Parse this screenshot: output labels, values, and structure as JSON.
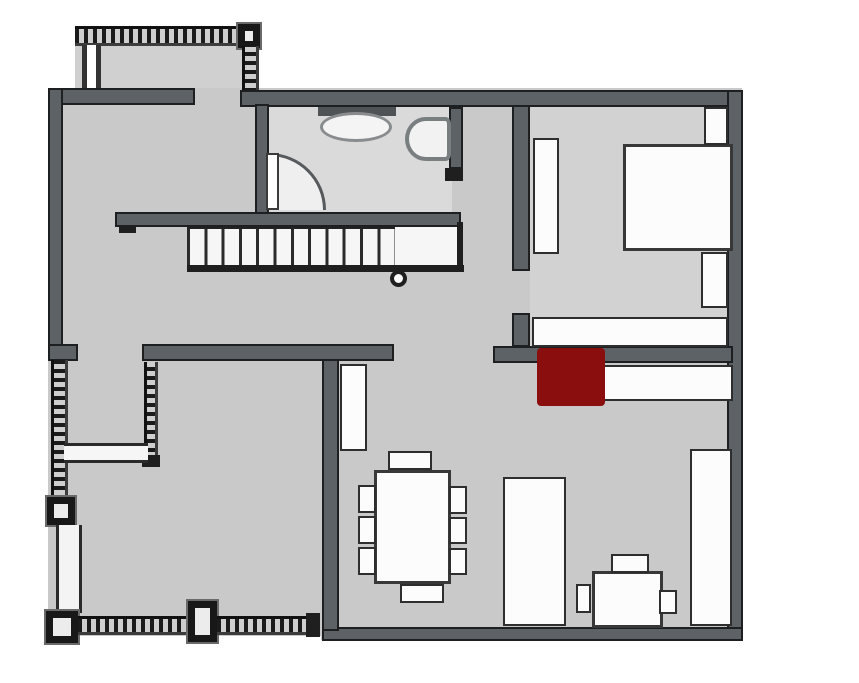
{
  "canvas": {
    "width": 859,
    "height": 683,
    "background": "#ffffff"
  },
  "palette": {
    "floor_gray": "#c9c9c9",
    "floor_light_gray": "#d6d6d6",
    "wall_gray": "#5d6266",
    "wall_edge_black": "#1e1f20",
    "furniture_white": "#fcfcfc",
    "highlight_red": "#8b0e0e"
  },
  "elements": [
    {
      "name": "balcony-floor",
      "type": "floor",
      "rect": [
        75,
        30,
        183,
        62
      ],
      "color": "#d0d0d0",
      "interactable": false
    },
    {
      "name": "main-floor",
      "type": "floor",
      "rect": [
        48,
        88,
        694,
        552
      ],
      "interactable": false
    },
    {
      "name": "bathroom-floor",
      "type": "floor",
      "rect": [
        262,
        104,
        190,
        110
      ],
      "color": "#dadada",
      "interactable": false
    },
    {
      "name": "bedroom-floor",
      "type": "floor",
      "rect": [
        530,
        107,
        198,
        242
      ],
      "color": "#d2d2d2",
      "interactable": false
    },
    {
      "name": "exterior-mask-bottom-left",
      "type": "mask",
      "rect": [
        0,
        636,
        321,
        47
      ],
      "interactable": false
    },
    {
      "name": "balcony-railing-top",
      "type": "railing-h",
      "rect": [
        75,
        26,
        183,
        20
      ],
      "interactable": false
    },
    {
      "name": "balcony-corner-post",
      "type": "post",
      "rect": [
        238,
        24,
        22,
        24
      ],
      "interactable": false
    },
    {
      "name": "balcony-railing-right",
      "type": "railing-v",
      "rect": [
        242,
        46,
        17,
        46
      ],
      "interactable": false
    },
    {
      "name": "balcony-window-strip",
      "type": "window-strip",
      "rect": [
        82,
        45,
        19,
        45
      ],
      "interactable": false
    },
    {
      "name": "wall-top-left",
      "type": "wall",
      "rect": [
        48,
        88,
        147,
        17
      ],
      "interactable": false
    },
    {
      "name": "wall-top-main",
      "type": "wall",
      "rect": [
        240,
        90,
        502,
        17
      ],
      "interactable": false
    },
    {
      "name": "wall-left",
      "type": "wall",
      "rect": [
        48,
        88,
        15,
        272
      ],
      "interactable": false
    },
    {
      "name": "wall-right",
      "type": "wall",
      "rect": [
        727,
        90,
        16,
        550
      ],
      "interactable": false
    },
    {
      "name": "wall-bottom",
      "type": "wall",
      "rect": [
        322,
        627,
        421,
        14
      ],
      "interactable": false
    },
    {
      "name": "wall-living-divider",
      "type": "wall",
      "rect": [
        322,
        355,
        17,
        276
      ],
      "interactable": false
    },
    {
      "name": "wall-mid-left-stub",
      "type": "wall",
      "rect": [
        48,
        344,
        30,
        17
      ],
      "interactable": false
    },
    {
      "name": "wall-mid-left",
      "type": "wall",
      "rect": [
        142,
        344,
        252,
        17
      ],
      "interactable": false
    },
    {
      "name": "wall-mid-right",
      "type": "wall",
      "rect": [
        493,
        346,
        240,
        17
      ],
      "interactable": false
    },
    {
      "name": "wall-bedroom-left",
      "type": "wall",
      "rect": [
        512,
        105,
        18,
        166
      ],
      "interactable": false
    },
    {
      "name": "wall-bedroom-left-stub",
      "type": "wall",
      "rect": [
        512,
        313,
        18,
        34
      ],
      "interactable": false
    },
    {
      "name": "wall-bathroom-left",
      "type": "wall",
      "rect": [
        255,
        104,
        14,
        123
      ],
      "interactable": false
    },
    {
      "name": "wall-bathroom-right",
      "type": "wall",
      "rect": [
        449,
        107,
        14,
        62
      ],
      "interactable": false
    },
    {
      "name": "bathroom-door2-stub",
      "type": "line",
      "rect": [
        445,
        168,
        18,
        13
      ],
      "interactable": false
    },
    {
      "name": "wall-stairs-top",
      "type": "wall",
      "rect": [
        115,
        212,
        346,
        15
      ],
      "interactable": false
    },
    {
      "name": "stairs-left-tick",
      "type": "line",
      "rect": [
        119,
        227,
        17,
        6
      ],
      "interactable": false
    },
    {
      "name": "stairs-treads",
      "type": "stairs-treads",
      "rect": [
        187,
        227,
        208,
        40
      ],
      "interactable": false
    },
    {
      "name": "stairs-landing",
      "type": "landing",
      "rect": [
        395,
        227,
        62,
        40
      ],
      "interactable": false
    },
    {
      "name": "stairs-bottom-line",
      "type": "line",
      "rect": [
        187,
        265,
        277,
        7
      ],
      "interactable": false
    },
    {
      "name": "stairs-landing-right-line",
      "type": "line",
      "rect": [
        457,
        222,
        6,
        50
      ],
      "interactable": false
    },
    {
      "name": "stairs-newel-post",
      "type": "circle",
      "rect": [
        390,
        270,
        17,
        17
      ],
      "interactable": false
    },
    {
      "name": "deck-railing-left",
      "type": "railing-v",
      "rect": [
        51,
        360,
        17,
        139
      ],
      "interactable": false
    },
    {
      "name": "deck-post-top",
      "type": "post",
      "rect": [
        47,
        497,
        28,
        28
      ],
      "interactable": false
    },
    {
      "name": "deck-rail-lower-left",
      "type": "rail-light",
      "rect": [
        56,
        525,
        26,
        88
      ],
      "interactable": false
    },
    {
      "name": "deck-post-bottom-left",
      "type": "post",
      "rect": [
        46,
        611,
        32,
        32
      ],
      "interactable": false
    },
    {
      "name": "deck-railing-bottom-1",
      "type": "railing-h",
      "rect": [
        78,
        616,
        112,
        19
      ],
      "interactable": false
    },
    {
      "name": "deck-post-bottom-mid",
      "type": "post",
      "rect": [
        188,
        601,
        29,
        41
      ],
      "interactable": false
    },
    {
      "name": "deck-railing-bottom-2",
      "type": "railing-h",
      "rect": [
        217,
        616,
        98,
        19
      ],
      "interactable": false
    },
    {
      "name": "deck-rail-end-nub",
      "type": "line",
      "rect": [
        306,
        613,
        14,
        24
      ],
      "interactable": false
    },
    {
      "name": "deck-inner-railing",
      "type": "railing-v",
      "rect": [
        144,
        362,
        14,
        99
      ],
      "interactable": false
    },
    {
      "name": "deck-inner-railing-end",
      "type": "line",
      "rect": [
        142,
        455,
        18,
        12
      ],
      "interactable": false
    },
    {
      "name": "deck-step",
      "type": "step",
      "rect": [
        64,
        443,
        84,
        20
      ],
      "interactable": false
    },
    {
      "name": "bathroom-sink-counter",
      "type": "counter",
      "rect": [
        318,
        107,
        78,
        9
      ],
      "interactable": false
    },
    {
      "name": "bathroom-sink",
      "type": "sink",
      "rect": [
        320,
        112,
        72,
        30
      ],
      "interactable": false
    },
    {
      "name": "bathroom-toilet",
      "type": "toilet",
      "rect": [
        405,
        117,
        46,
        44
      ],
      "interactable": false
    },
    {
      "name": "bathroom-door-arc",
      "type": "door-arc",
      "rect": [
        269,
        153,
        57,
        57
      ],
      "interactable": false
    },
    {
      "name": "bathroom-door-leaf",
      "type": "door-leaf",
      "rect": [
        266,
        153,
        13,
        57
      ],
      "interactable": false
    },
    {
      "name": "bedroom-wardrobe",
      "type": "furniture",
      "rect": [
        533,
        138,
        26,
        116
      ],
      "interactable": false
    },
    {
      "name": "bed",
      "type": "furniture-thick",
      "rect": [
        623,
        144,
        110,
        107
      ],
      "interactable": false
    },
    {
      "name": "nightstand-top",
      "type": "furniture",
      "rect": [
        704,
        107,
        24,
        38
      ],
      "interactable": false
    },
    {
      "name": "nightstand-bottom",
      "type": "furniture",
      "rect": [
        701,
        252,
        27,
        56
      ],
      "interactable": false
    },
    {
      "name": "bedroom-dresser",
      "type": "furniture",
      "rect": [
        532,
        317,
        196,
        30
      ],
      "interactable": false
    },
    {
      "name": "hall-sideboard",
      "type": "furniture",
      "rect": [
        537,
        365,
        196,
        36
      ],
      "interactable": false
    },
    {
      "name": "highlight-square",
      "type": "highlight",
      "rect": [
        537,
        348,
        68,
        58
      ],
      "interactable": true
    },
    {
      "name": "living-shelf",
      "type": "furniture",
      "rect": [
        340,
        364,
        27,
        87
      ],
      "interactable": false
    },
    {
      "name": "dining-chair-top",
      "type": "furniture",
      "rect": [
        388,
        451,
        44,
        19
      ],
      "interactable": false
    },
    {
      "name": "dining-table",
      "type": "furniture-thick",
      "rect": [
        374,
        470,
        77,
        114
      ],
      "interactable": false
    },
    {
      "name": "dining-chair-left-1",
      "type": "furniture",
      "rect": [
        358,
        485,
        18,
        28
      ],
      "interactable": false
    },
    {
      "name": "dining-chair-left-2",
      "type": "furniture",
      "rect": [
        358,
        516,
        18,
        28
      ],
      "interactable": false
    },
    {
      "name": "dining-chair-left-3",
      "type": "furniture",
      "rect": [
        358,
        547,
        18,
        28
      ],
      "interactable": false
    },
    {
      "name": "dining-chair-right-1",
      "type": "furniture",
      "rect": [
        449,
        486,
        18,
        28
      ],
      "interactable": false
    },
    {
      "name": "dining-chair-right-2",
      "type": "furniture",
      "rect": [
        449,
        517,
        18,
        27
      ],
      "interactable": false
    },
    {
      "name": "dining-chair-right-3",
      "type": "furniture",
      "rect": [
        449,
        548,
        18,
        27
      ],
      "interactable": false
    },
    {
      "name": "dining-chair-bottom",
      "type": "furniture",
      "rect": [
        400,
        584,
        44,
        19
      ],
      "interactable": false
    },
    {
      "name": "sofa",
      "type": "furniture",
      "rect": [
        503,
        477,
        63,
        149
      ],
      "interactable": false
    },
    {
      "name": "wall-unit-right",
      "type": "furniture",
      "rect": [
        690,
        449,
        42,
        177
      ],
      "interactable": false
    },
    {
      "name": "desk",
      "type": "furniture-thick",
      "rect": [
        592,
        571,
        71,
        57
      ],
      "interactable": false
    },
    {
      "name": "desk-chair-top",
      "type": "furniture",
      "rect": [
        611,
        554,
        38,
        19
      ],
      "interactable": false
    },
    {
      "name": "desk-chair-left",
      "type": "furniture",
      "rect": [
        576,
        584,
        15,
        29
      ],
      "interactable": false
    },
    {
      "name": "desk-chair-right",
      "type": "furniture",
      "rect": [
        659,
        590,
        18,
        24
      ],
      "interactable": false
    }
  ]
}
